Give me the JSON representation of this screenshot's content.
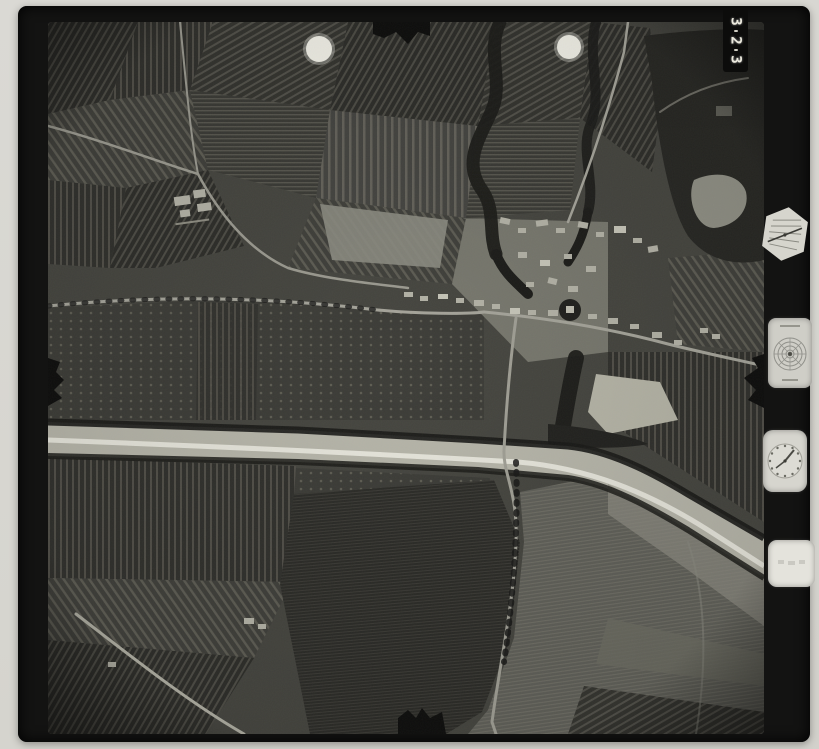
{
  "mount": {
    "frame_number": "3-2-3",
    "frame_number_digits": [
      "3",
      "2",
      "3"
    ]
  },
  "data_strip": {
    "instruments": [
      {
        "name": "altimeter-gauge"
      },
      {
        "name": "bubble-level"
      },
      {
        "name": "clock"
      },
      {
        "name": "data-plate"
      }
    ]
  },
  "photo": {
    "type": "vintage aerial survey photograph",
    "registration_marks": 2,
    "fiducial_marks": 4,
    "features": [
      "striped farm parcels",
      "village crossroads",
      "wide light riverbed",
      "winding dark creek",
      "woodland with pond",
      "tree-lined roads"
    ]
  },
  "colors": {
    "mount": "#dad9d4",
    "film": "#131312",
    "photo_base": "#45453f",
    "riverbed": "#b6b5a9",
    "channel": "#e9e8dd",
    "road": "#a5a49a",
    "building": "#b3b2a6",
    "vegetation": "#1c1c19"
  }
}
